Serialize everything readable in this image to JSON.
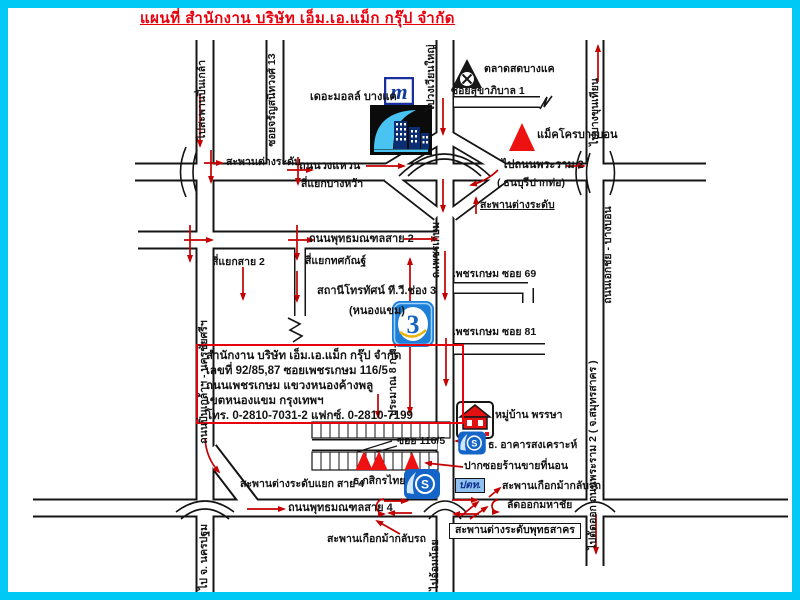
{
  "title": "แผนที่ สำนักงาน บริษัท เอ็ม.เอ.แม็ก กรุ๊ป จำกัด",
  "colors": {
    "frame": "#00c9f6",
    "title_red": "#e8000d",
    "arrow_red": "#c40000",
    "triangle_red": "#ee1111",
    "logo_blue": "#1565c8"
  },
  "roads": {
    "to_pinklao": "ไปสะพานปิ่นเกล้า",
    "soi_charan_13": "ซอยจรัญสนิทวงศ์ 13",
    "to_wongwianyai": "ไปวงเวียนใหญ่",
    "to_bangkhunthian": "ไปบางขุนเทียน",
    "wongwaen": "ถนนวงแหวน",
    "to_rama2": "ไปถนนพระราม 2",
    "thonburi_pakto": "( ธนบุรีปากท่อ)",
    "phetkasem": "ถ.เพชรเกษม",
    "ekkachai_bangbon": "ถนนเอกชัย - บางบอน",
    "sai2": "ถนนพุทธมณฑลสาย 2",
    "pinklao_nakhonchaisi": "ถนนปิ่นเกล้าฯ - นครชัยศรีฯ",
    "phetkasem_soi69": "เพชรเกษม ซอย 69",
    "phetkasem_soi81": "เพชรเกษม ซอย 81",
    "soi_sukhaphiban1": "ซอยสุขาภิบาล 1",
    "sai4": "ถนนพุทธมณฑลสาย 4",
    "soi_116_5": "ซอย 116/5",
    "to_nakhonpathom": "ไป จ. นครปฐม",
    "to_omnoi": "ไปอ้อมน้อย",
    "to_rama2_samutsakhon": "ไปตัดออก ถนนพระราม 2 ( จ.สมุทรสาคร )",
    "approx_8km": "ประมาณ 8 ก.ม."
  },
  "junctions": {
    "interchange_left": "สะพานต่างระดับ",
    "interchange_right": "สะพานต่างระดับ",
    "bangwa": "สี่แยกบางหว้า",
    "sai2_intersection": "สี่แยกสาย 2",
    "totsakan": "สี่แยกทศกัณฐ์",
    "sai4_interchange": "สะพานต่างระดับแยก สาย 4",
    "horseshoe_right": "สะพานเกือกม้ากลับรถ",
    "horseshoe_bottom": "สะพานเกือกม้ากลับรถ",
    "mahachai_shortcut": "ลัดออกมหาชัย",
    "phutthasakhon": "สะพานต่างระดับพุทธสาคร"
  },
  "places": {
    "the_mall": "เดอะมอลล์ บางแค",
    "market": "ตลาดสดบางแค",
    "makro": "แม็คโครบางบอน",
    "channel3_station": "สถานีโทรทัศน์ ที.วี.ช่อง 3",
    "nong_khaem": "(หนองแขม)",
    "village": "หมู่บ้าน พรรษา",
    "ghb_bank": "ธ. อาคารสงเคราะห์",
    "mattress_shop": "ปากซอยร้านขายที่นอน",
    "kbank": "ธ.กสิกรไทย",
    "ptt": "ปตท."
  },
  "office": {
    "line1": "สำนักงาน บริษัท เอ็ม.เอ.แม็ก กรุ๊ป จำกัด",
    "line2": "เลขที่ 92/85,87 ซอยเพชรเกษม 116/5",
    "line3": "ถนนเพชรเกษม แขวงหนองค้างพลู",
    "line4": "เขตหนองแขม กรุงเทพฯ",
    "line5": "โทร. 0-2810-7031-2 แฟกซ์. 0-2810-7199"
  },
  "icons": {
    "m_logo_letter": "m",
    "channel3_number": "3",
    "bank_letter": "S"
  }
}
